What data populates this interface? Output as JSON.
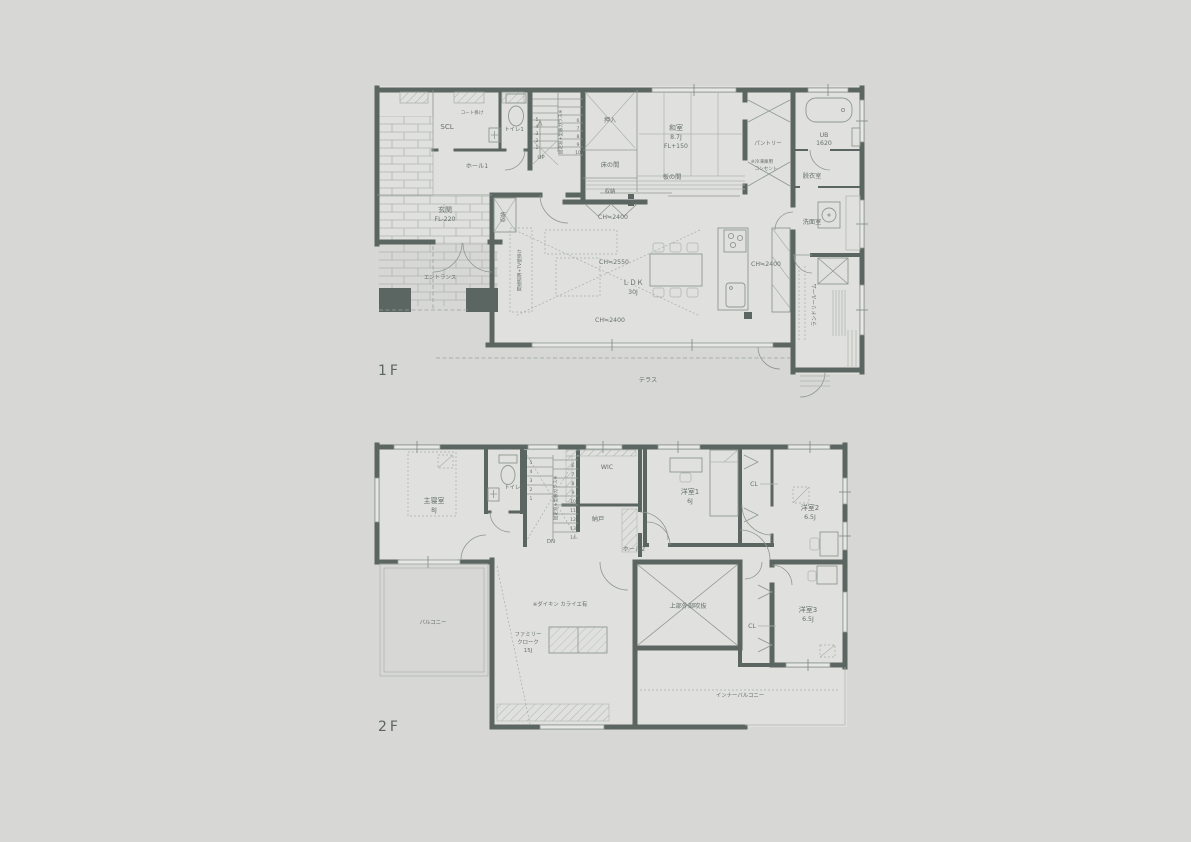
{
  "floor1": {
    "label": "1F",
    "terrace": "テラス",
    "rooms": {
      "scl": "SCL",
      "coat_hook": "コート掛け",
      "toilet": "トイレ1",
      "hall": "ホール1",
      "genkan": "玄関",
      "genkan_fl": "FL-220",
      "entrance": "エントランス",
      "oshiire": "押入",
      "tokonoma": "床の間",
      "closet_tokonoma": "収納",
      "closet_ldk": "収納",
      "washitsu": "和室",
      "washitsu_size": "8.7J",
      "washitsu_fl": "FL+150",
      "itanoma": "板の間",
      "pantry": "パントリー",
      "ub": "UB",
      "ub_size": "1620",
      "datsuishitsu": "脱衣室",
      "senmenshitsu": "洗面室",
      "laundry": "ランドリールーム",
      "ldk": "ＬＤＫ",
      "ldk_size": "30J"
    },
    "notes": {
      "freezer1": "※冷凍庫用",
      "freezer2": "コンセント",
      "tv_wall": "間接照明+TV壁掛け",
      "stair": "固定窓+型板ガラス※",
      "ch_top": "CH≒2400",
      "ch_mid": "CH≒2550",
      "ch_bottom": "CH≒2400",
      "ch_right": "CH≒2400"
    },
    "stairs": {
      "dir": "UP",
      "left": [
        "5",
        "4",
        "3",
        "2",
        "1"
      ],
      "right": [
        "6",
        "7",
        "8",
        "9",
        "10"
      ]
    }
  },
  "floor2": {
    "label": "2F",
    "rooms": {
      "master": "主寝室",
      "master_size": "8J",
      "toilet": "トイレ2",
      "wic": "WIC",
      "nando": "納戸",
      "hall": "ホール2",
      "yoshitsu1": "洋室1",
      "yoshitsu1_size": "6J",
      "cl1": "CL",
      "yoshitsu2": "洋室2",
      "yoshitsu2_size": "6.5J",
      "balcony": "バルコニー",
      "family_cloak1": "ファミリー",
      "family_cloak2": "クローク",
      "family_cloak3": "15J",
      "void_space": "上部外部吹抜",
      "cl2": "CL",
      "yoshitsu3": "洋室3",
      "yoshitsu3_size": "6.5J",
      "inner_balcony": "インナーバルコニー"
    },
    "notes": {
      "daikin": "※ダイキン カライエ有",
      "stair": "固定窓+型板ガラス※"
    },
    "stairs": {
      "dir": "DN",
      "left": [
        "5",
        "4",
        "3",
        "2",
        "1"
      ],
      "right": [
        "6",
        "7",
        "8",
        "9",
        "10",
        "11",
        "12",
        "13",
        "14"
      ]
    }
  }
}
